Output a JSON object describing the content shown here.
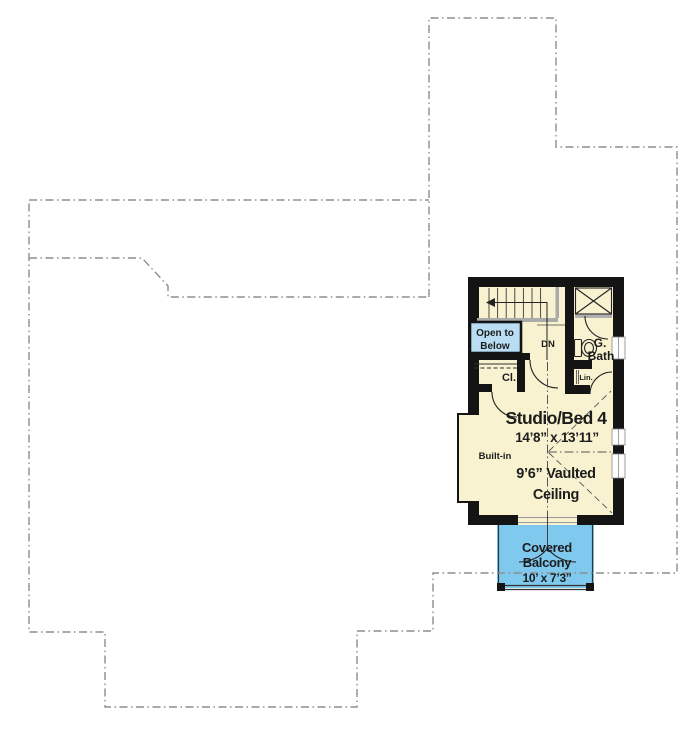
{
  "plan": {
    "room_title": "Studio/Bed 4",
    "room_dimensions": "14’8” x 13’11”",
    "ceiling_line1": "9’6” Vaulted",
    "ceiling_line2": "Ceiling",
    "balcony_line1": "Covered",
    "balcony_line2": "Balcony",
    "balcony_dimensions": "10’ x 7’3”",
    "open_below_line1": "Open to",
    "open_below_line2": "Below",
    "stairs_label": "DN",
    "closet_label": "Cl.",
    "bath_line1": "G.",
    "bath_line2": "Bath",
    "linen_label": "Lin.",
    "builtin_label": "Built-in"
  },
  "colors": {
    "floor": "#f8f2d0",
    "balcony": "#7fc9ef",
    "open_below": "#b9def4",
    "wall": "#141414",
    "lower_floor_outline": "#8d8d8d"
  }
}
